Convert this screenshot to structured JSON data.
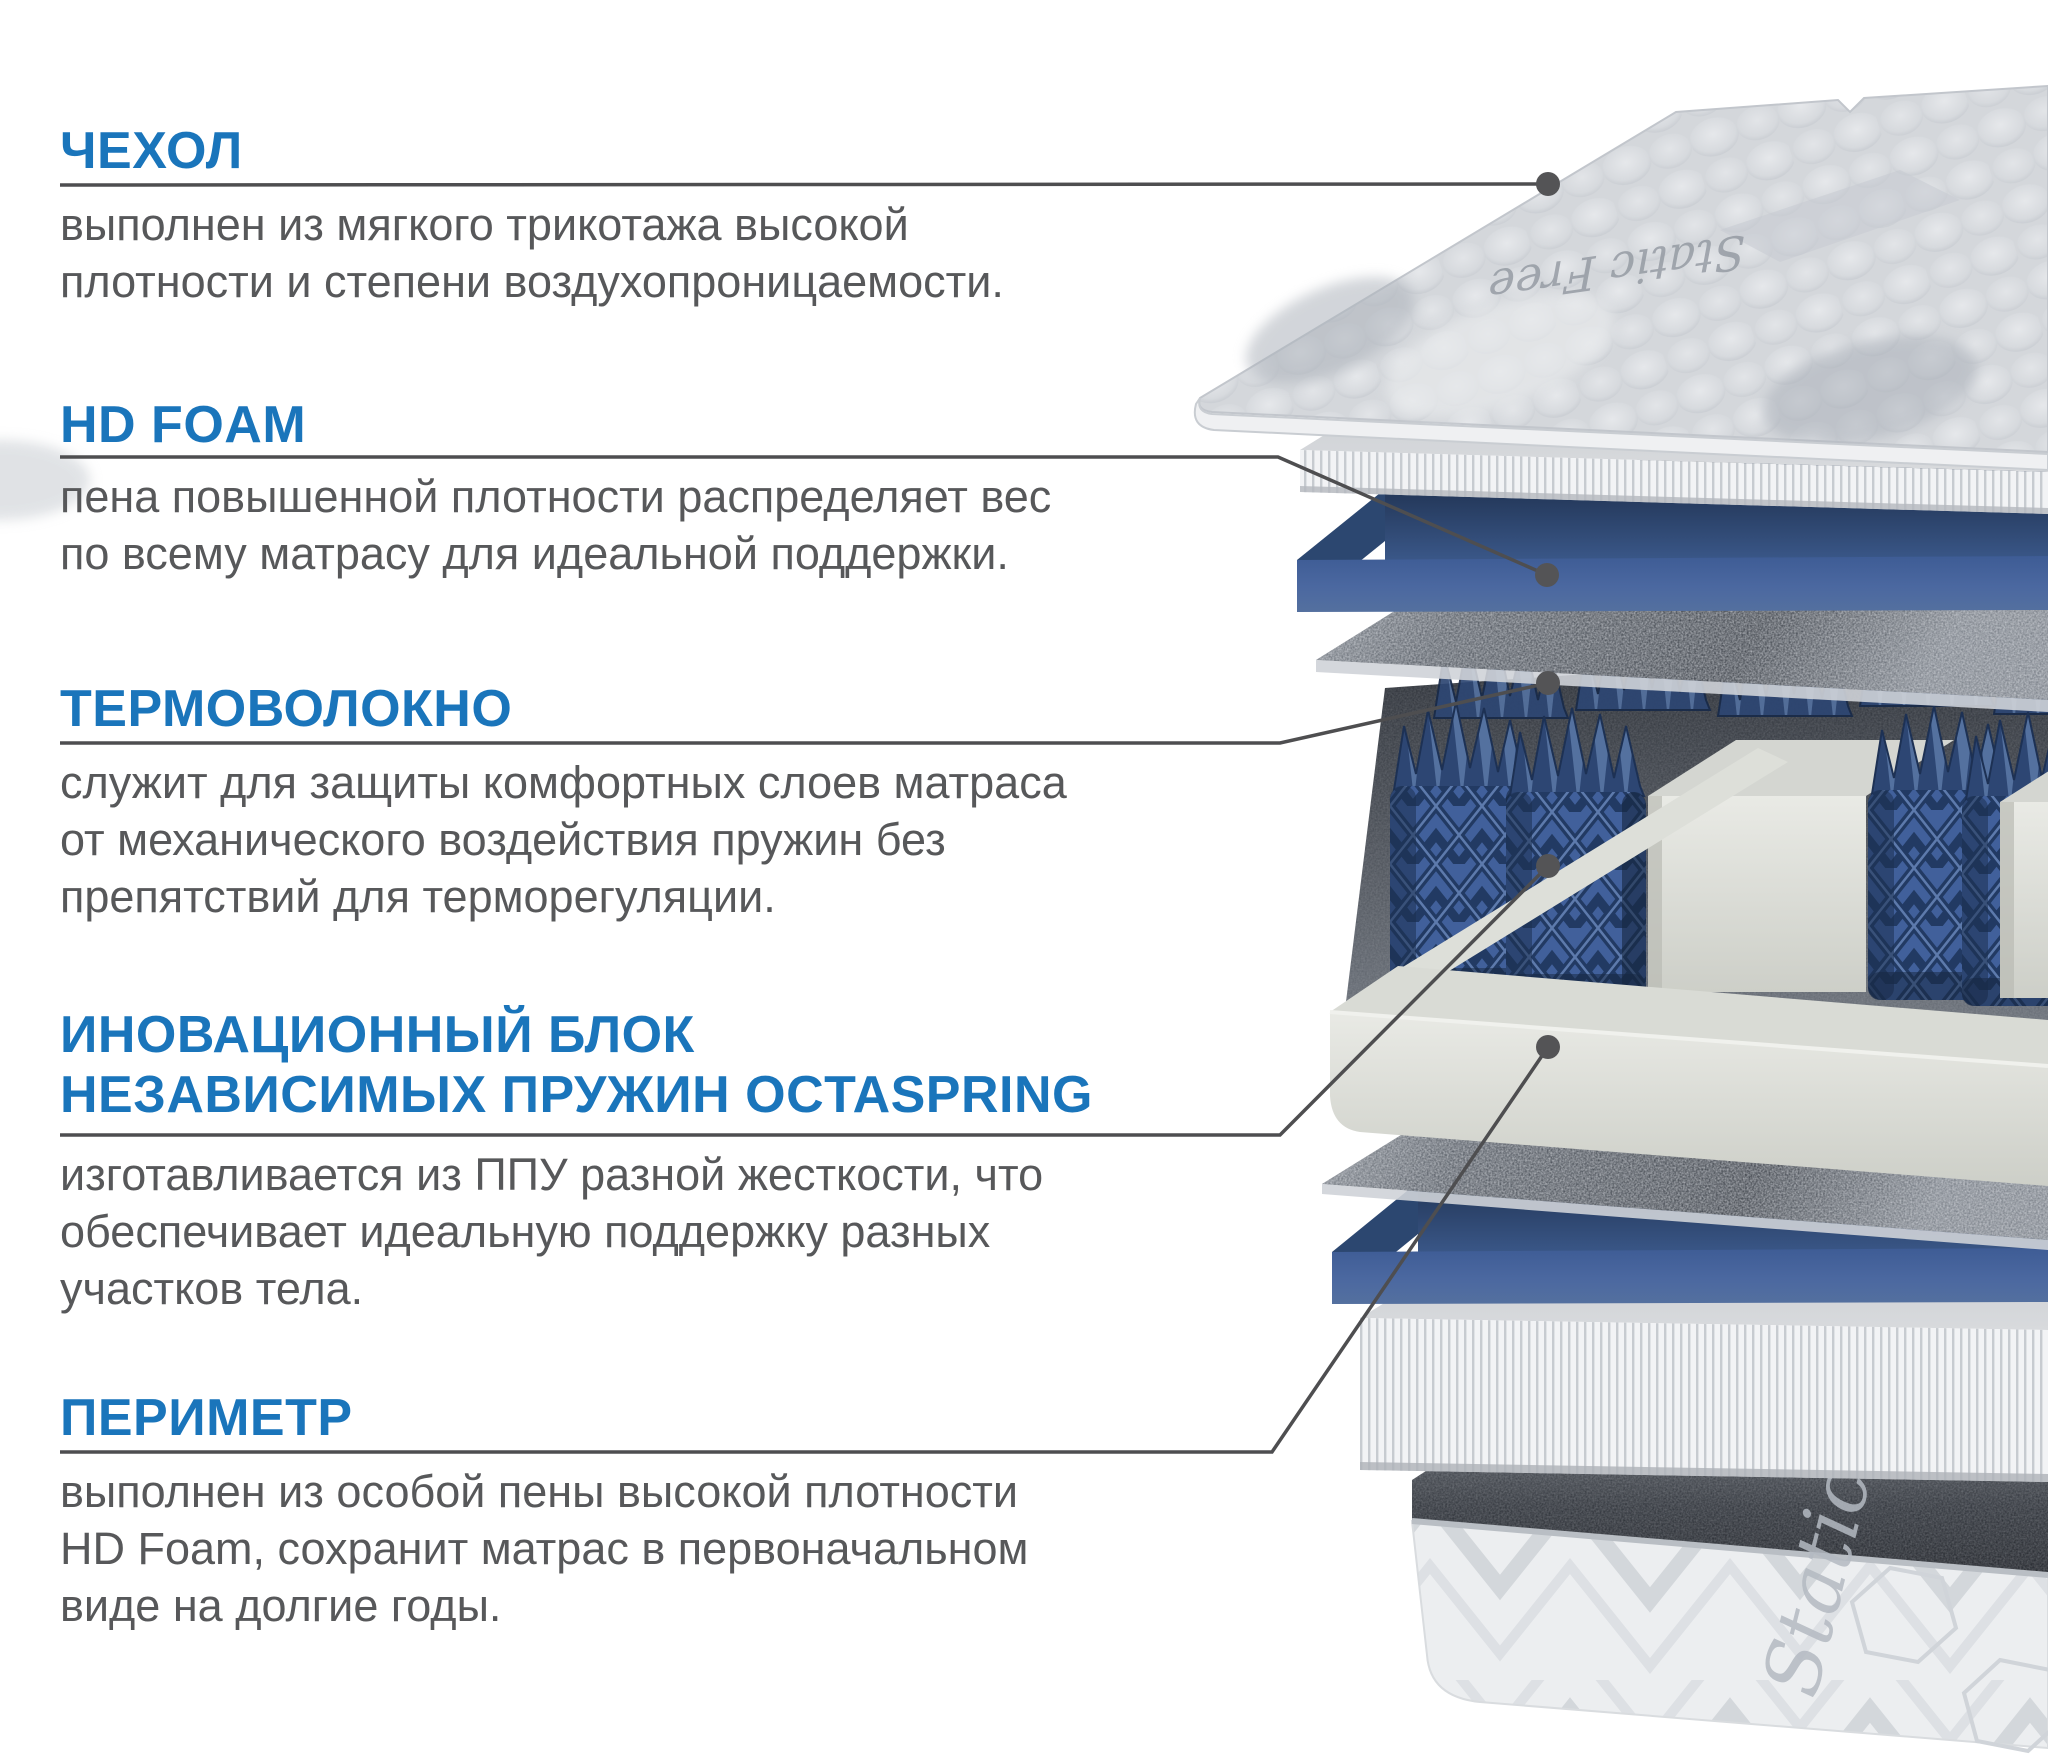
{
  "sections": [
    {
      "id": "cover",
      "title": "ЧЕХОЛ",
      "body": "выполнен из мягкого трикотажа высокой\nплотности и степени воздухопроницаемости."
    },
    {
      "id": "hd-foam",
      "title": "HD FOAM",
      "body": "пена повышенной плотности распределяет вес\nпо всему матрасу для идеальной поддержки."
    },
    {
      "id": "thermo-fiber",
      "title": "ТЕРМОВОЛОКНО",
      "body": "служит для защиты комфортных слоев матраса\nот механического воздействия пружин без\nпрепятствий для терморегуляции."
    },
    {
      "id": "octaspring",
      "title": "ИНОВАЦИОННЫЙ БЛОК\nНЕЗАВИСИМЫХ ПРУЖИН OCTASPRING",
      "body": "изготавливается из ППУ разной жесткости, что\nобеспечивает идеальную поддержку разных\nучастков тела."
    },
    {
      "id": "perimeter",
      "title": "ПЕРИМЕТР",
      "body": "выполнен из особой пены высокой плотности\nHD Foam, сохранит матрас в первоначальном\nвиде на долгие годы."
    }
  ],
  "illustration": {
    "base_label": "Static Free",
    "cover_label": "Static Free"
  },
  "colors": {
    "accent": "#1a75bb",
    "body_text": "#57585a",
    "callout_line": "#4e4e50",
    "foam_blue": "#4b68a0"
  }
}
